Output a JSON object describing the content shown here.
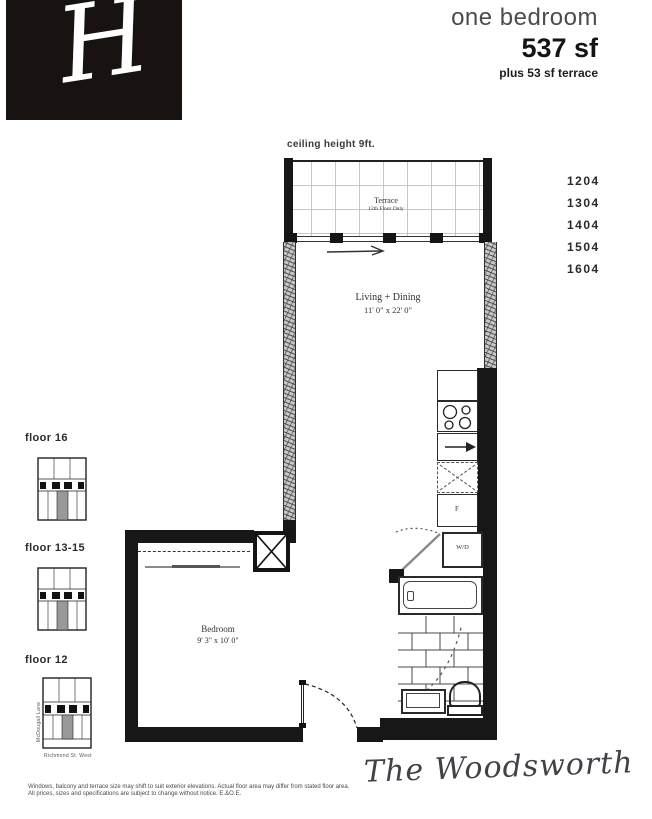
{
  "header": {
    "logo_letter": "H",
    "unit_type": "one bedroom",
    "area": "537 sf",
    "area_extra": "plus 53 sf terrace"
  },
  "plan": {
    "ceiling_note": "ceiling height 9ft.",
    "rooms": {
      "terrace": {
        "name": "Terrace",
        "note": "12th Floor Only"
      },
      "living": {
        "name": "Living + Dining",
        "dims": "11' 0\" x 22' 0\""
      },
      "bedroom": {
        "name": "Bedroom",
        "dims": "9' 3\" x 10' 0\""
      },
      "laundry": "W/D",
      "fridge": "F"
    }
  },
  "units": [
    "1204",
    "1304",
    "1404",
    "1504",
    "1604"
  ],
  "keyplans": [
    {
      "label": "floor 16"
    },
    {
      "label": "floor 13-15"
    },
    {
      "label": "floor 12",
      "street_left": "McDougall Lane",
      "street_bottom": "Richmond St. West"
    }
  ],
  "footer": {
    "disclaimer_line1": "Windows, balcony and terrace size may shift to suit exterior elevations. Actual floor area may differ from stated floor area.",
    "disclaimer_line2": "All prices, sizes and specifications are subject to change without notice. E.&O.E.",
    "brand": "The Woodsworth"
  },
  "colors": {
    "wall": "#171717",
    "logo_bg": "#181310",
    "keyplan_highlight": "#999999"
  }
}
